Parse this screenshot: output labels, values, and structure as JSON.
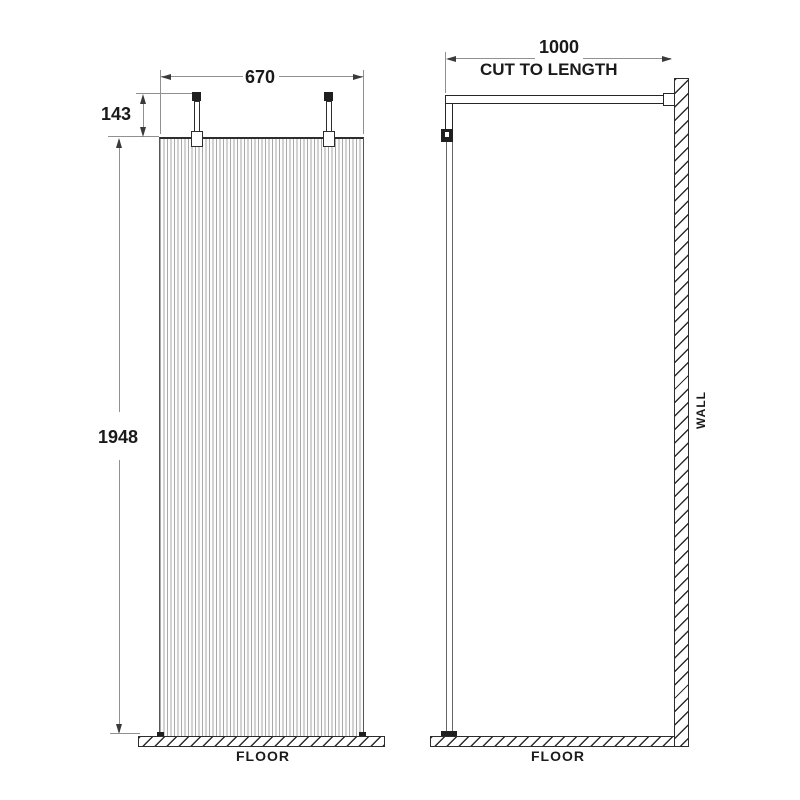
{
  "theme": {
    "bg": "#ffffff",
    "ink": "#2d2d2d",
    "dim": "#909090",
    "text": "#1a1a1a",
    "flute": "#a8a8a8",
    "arrow": "#3a3a3a"
  },
  "front_view": {
    "width_dim": "670",
    "bracket_height_dim": "143",
    "panel_height_dim": "1948",
    "floor_label": "FLOOR"
  },
  "side_view": {
    "arm_length_dim": "1000",
    "arm_note": "CUT TO LENGTH",
    "wall_label": "WALL",
    "floor_label": "FLOOR"
  }
}
